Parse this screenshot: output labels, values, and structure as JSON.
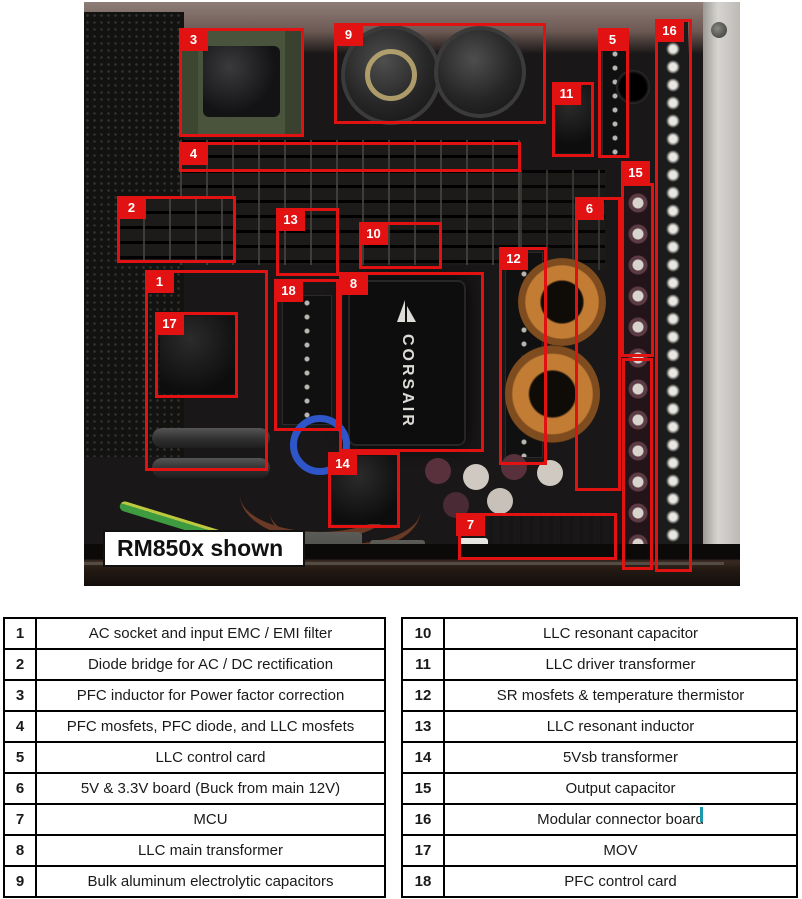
{
  "figure": {
    "caption_label": "RM850x shown",
    "transformer_brand": "CORSAIR",
    "annotation_color": "#e21212"
  },
  "callouts": [
    {
      "num": "1",
      "box": [
        145,
        270,
        123,
        201
      ],
      "chip": [
        145,
        270
      ]
    },
    {
      "num": "2",
      "box": [
        117,
        196,
        119,
        67
      ],
      "chip": [
        117,
        196
      ]
    },
    {
      "num": "3",
      "box": [
        179,
        28,
        125,
        109
      ],
      "chip": [
        179,
        28
      ]
    },
    {
      "num": "4",
      "box": [
        179,
        142,
        342,
        30
      ],
      "chip": [
        179,
        142
      ]
    },
    {
      "num": "5",
      "box": [
        598,
        28,
        31,
        130
      ],
      "chip": [
        598,
        28
      ]
    },
    {
      "num": "6",
      "box": [
        575,
        197,
        46,
        294
      ],
      "chip": [
        575,
        197
      ]
    },
    {
      "num": "7",
      "box": [
        458,
        513,
        159,
        47
      ],
      "chip": [
        456,
        513
      ]
    },
    {
      "num": "8",
      "box": [
        339,
        272,
        145,
        180
      ],
      "chip": [
        339,
        272
      ]
    },
    {
      "num": "9",
      "box": [
        334,
        23,
        212,
        101
      ],
      "chip": [
        334,
        23
      ]
    },
    {
      "num": "10",
      "box": [
        359,
        222,
        83,
        47
      ],
      "chip": [
        359,
        222
      ]
    },
    {
      "num": "11",
      "box": [
        552,
        82,
        42,
        75
      ],
      "chip": [
        552,
        82
      ]
    },
    {
      "num": "12",
      "box": [
        499,
        247,
        48,
        218
      ],
      "chip": [
        499,
        247
      ]
    },
    {
      "num": "13",
      "box": [
        276,
        208,
        63,
        68
      ],
      "chip": [
        276,
        208
      ]
    },
    {
      "num": "14",
      "box": [
        328,
        452,
        72,
        76
      ],
      "chip": [
        328,
        452
      ]
    },
    {
      "num": "15",
      "box": [
        621,
        183,
        33,
        174
      ],
      "chip": [
        621,
        161
      ]
    },
    {
      "num": "16",
      "box": [
        655,
        19,
        37,
        553
      ],
      "chip": [
        655,
        19
      ]
    },
    {
      "num": "17",
      "box": [
        155,
        312,
        83,
        86
      ],
      "chip": [
        155,
        312
      ]
    },
    {
      "num": "18",
      "box": [
        274,
        279,
        65,
        152
      ],
      "chip": [
        274,
        279
      ]
    }
  ],
  "extra_boxes": [
    {
      "box": [
        622,
        358,
        31,
        212
      ]
    }
  ],
  "legend": {
    "left_rows": [
      {
        "num": "1",
        "desc": "AC socket and input EMC / EMI filter"
      },
      {
        "num": "2",
        "desc": "Diode bridge for AC / DC rectification"
      },
      {
        "num": "3",
        "desc": "PFC inductor for Power factor correction"
      },
      {
        "num": "4",
        "desc": "PFC mosfets, PFC diode, and LLC mosfets"
      },
      {
        "num": "5",
        "desc": "LLC control card"
      },
      {
        "num": "6",
        "desc": "5V & 3.3V board (Buck from main 12V)"
      },
      {
        "num": "7",
        "desc": "MCU"
      },
      {
        "num": "8",
        "desc": "LLC main transformer"
      },
      {
        "num": "9",
        "desc": "Bulk aluminum electrolytic capacitors"
      }
    ],
    "right_rows": [
      {
        "num": "10",
        "desc": "LLC resonant capacitor"
      },
      {
        "num": "11",
        "desc": "LLC driver transformer"
      },
      {
        "num": "12",
        "desc": "SR mosfets & temperature thermistor"
      },
      {
        "num": "13",
        "desc": "LLC resonant inductor"
      },
      {
        "num": "14",
        "desc": "5Vsb transformer"
      },
      {
        "num": "15",
        "desc": "Output capacitor"
      },
      {
        "num": "16",
        "desc": "Modular connector board"
      },
      {
        "num": "17",
        "desc": "MOV"
      },
      {
        "num": "18",
        "desc": "PFC control card"
      }
    ]
  }
}
